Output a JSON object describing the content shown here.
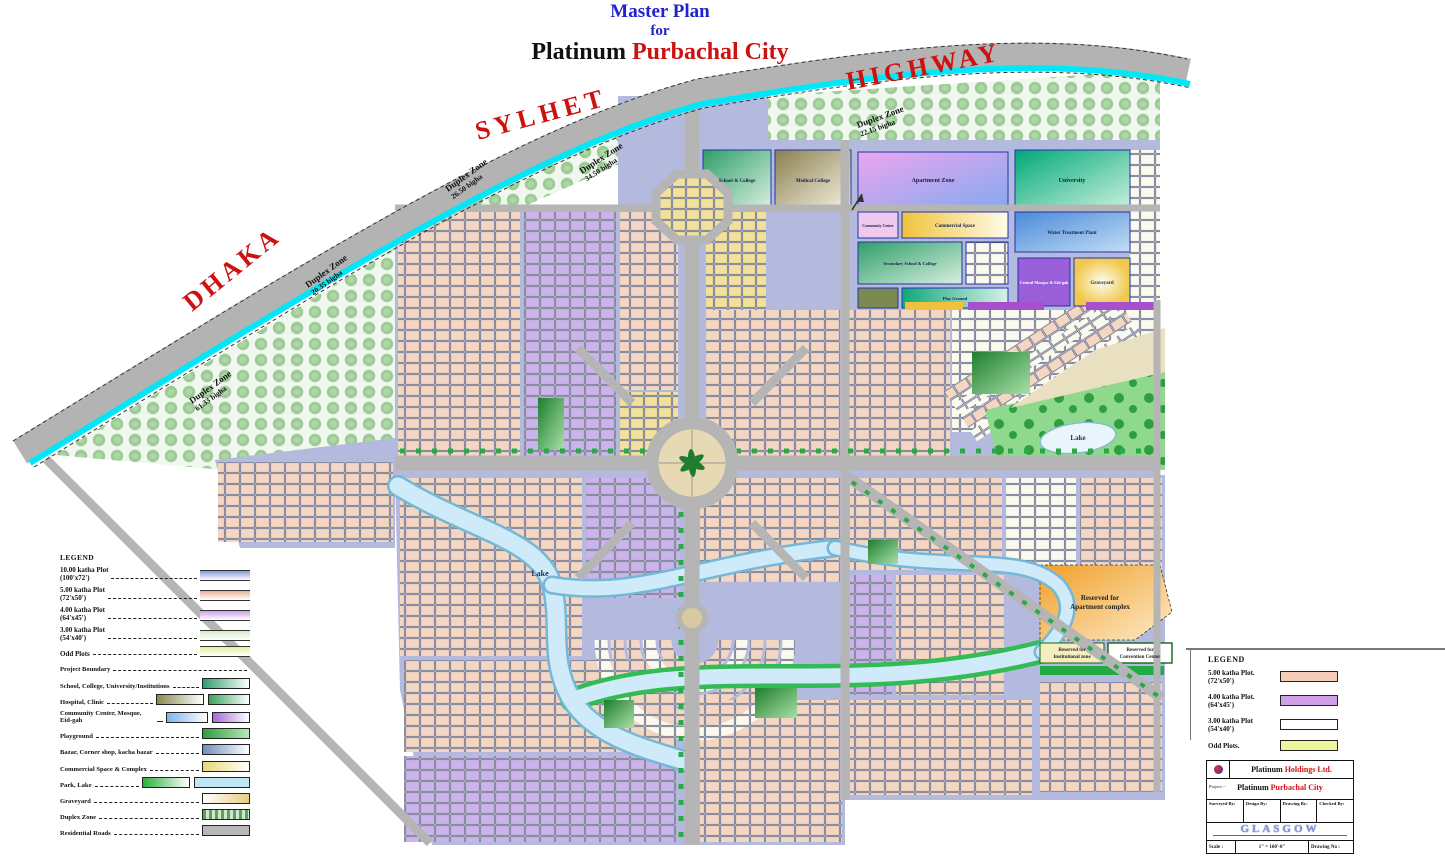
{
  "title": {
    "line1": "Master Plan",
    "line2": "for",
    "name_black": "Platinum",
    "name_red": "Purbachal City"
  },
  "highway": {
    "dhaka": "DHAKA",
    "sylhet": "SYLHET",
    "highway": "HIGHWAY"
  },
  "duplex_zones": [
    {
      "line1": "Duplex Zone",
      "line2": "26.50 bigha"
    },
    {
      "line1": "Duplex Zone",
      "line2": "34.50 bigha"
    },
    {
      "line1": "Duplex Zone",
      "line2": "22.15 bigha"
    },
    {
      "line1": "Duplex Zone",
      "line2": "20.35 bigha"
    },
    {
      "line1": "Duplex Zone",
      "line2": "61.33 bigha"
    }
  ],
  "facilities": {
    "school": "School & College",
    "medical": "Medical College",
    "apartment": "Apartment Zone",
    "university": "University",
    "community": "Community Center",
    "commercial": "Commercial Space",
    "water": "Water Treatment Plant",
    "secondary": "Secondary School & College",
    "mosque": "Central Mosque & Eid-gah",
    "graveyard": "Graveyard",
    "playground": "Play Ground"
  },
  "map_labels": {
    "lake_left": "Lake",
    "lake_right": "Lake",
    "reserved_apartment_l1": "Reserved for",
    "reserved_apartment_l2": "Apartment complex",
    "reserved_inst_l1": "Reserved for",
    "reserved_inst_l2": "Institutional zone",
    "reserved_conv_l1": "Reserved for",
    "reserved_conv_l2": "Convention Center"
  },
  "legend_left": {
    "title": "LEGEND",
    "plots": [
      {
        "label": "10.00 katha Plot",
        "dims": "(100'x72')",
        "color": "#8899dd"
      },
      {
        "label": "5.00 katha Plot",
        "dims": "(72'x50')",
        "color": "#e8b39a"
      },
      {
        "label": "4.00 katha Plot",
        "dims": "(64'x45')",
        "color": "#cf9fe8"
      },
      {
        "label": "3.00 katha Plot",
        "dims": "(54'x40')",
        "color": "#d8ecc8"
      },
      {
        "label": "Odd Plots",
        "dims": "",
        "color": "#e8f09a"
      }
    ],
    "features": [
      {
        "label": "Project Boundary",
        "colors": []
      },
      {
        "label": "School, College, University/Institutions",
        "colors": [
          "#2f9e6e"
        ]
      },
      {
        "label": "Hospital, Clinic",
        "colors": [
          "#8a8a52",
          "#3da35a"
        ]
      },
      {
        "label": "Community Center, Mosque, Eid-gah",
        "colors": [
          "#7fb3f0",
          "#a868d8"
        ]
      },
      {
        "label": "Playground",
        "colors": [
          "#2f9e3e"
        ]
      },
      {
        "label": "Bazar, Corner shop, kacha bazar",
        "colors": [
          "#6f8fb8"
        ]
      },
      {
        "label": "Commercial Space & Complex",
        "colors": [
          "#e8d878"
        ]
      },
      {
        "label": "Park, Lake",
        "colors": [
          "#2fae3e",
          "#bfe6f5"
        ]
      },
      {
        "label": "Graveyard",
        "colors": [
          "#e8cc80"
        ]
      },
      {
        "label": "Duplex Zone",
        "colors": [
          "#5f9e5f"
        ]
      },
      {
        "label": "Residential Roads",
        "colors": [
          "#b8b8b8"
        ]
      }
    ]
  },
  "legend_right": {
    "title": "LEGEND",
    "plots": [
      {
        "label": "5.00 katha Plot.",
        "dims": "(72'x50')",
        "color": "#f5cdb8"
      },
      {
        "label": "4.00 katha Plot.",
        "dims": "(64'x45')",
        "color": "#cf9fe8"
      },
      {
        "label": "3.00 katha Plot",
        "dims": "(54'x40')",
        "color": "#ffffff"
      },
      {
        "label": "Odd Plots.",
        "dims": "",
        "color": "#eef59a"
      }
    ]
  },
  "title_block": {
    "company_black": "Platinum ",
    "company_red": "Holdings Ltd.",
    "project_label": "Project :-",
    "project_black": "Platinum ",
    "project_red": "Purbachal City",
    "col1": "Surveyed By:",
    "col2": "Design By:",
    "col3": "Drawing By:",
    "col4": "Checked By:",
    "firm": "GLASGOW",
    "scale_label": "Scale :",
    "scale_value": "1\" = 160'-0\"",
    "drawing_label": "Drawing No :"
  }
}
